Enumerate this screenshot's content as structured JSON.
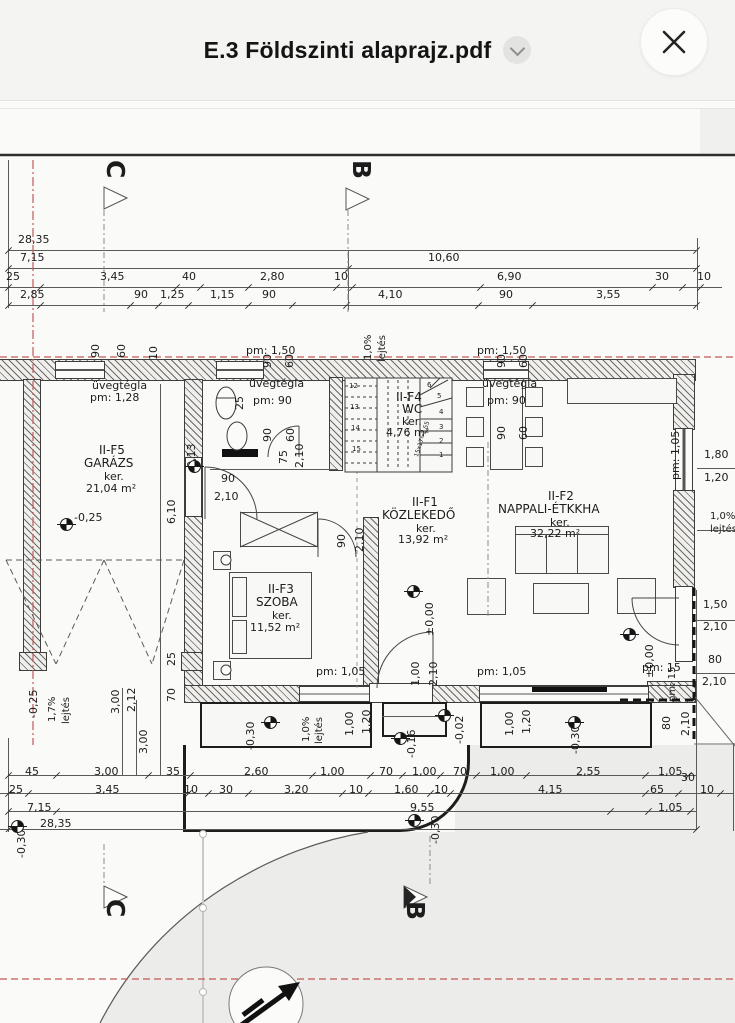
{
  "header": {
    "title": "E.3 Földszinti alaprajz.pdf",
    "dropdown_icon": "chevron-down",
    "close_icon": "close-x"
  },
  "colors": {
    "header_bg": "#f4f4f2",
    "line": "#3d3d3b",
    "axis_red": "#c25a56",
    "ground": "#ececea"
  },
  "plan": {
    "rooms": [
      {
        "id": "II-F5",
        "name": "GARÁZS",
        "area": "21,04 m²"
      },
      {
        "id": "II-F4",
        "name": "WC",
        "area": "4,76 m²"
      },
      {
        "id": "II-F1",
        "name": "KÖZLEKEDŐ",
        "area": "13,92 m²"
      },
      {
        "id": "II-F2",
        "name": "NAPPALI-ÉTKKHA",
        "area": "32,22 m²"
      },
      {
        "id": "II-F3",
        "name": "SZOBA",
        "area": "11,52 m²"
      }
    ],
    "labels": [
      {
        "t": "28,35",
        "x": 18,
        "y": 234
      },
      {
        "t": "7,15",
        "x": 20,
        "y": 252
      },
      {
        "t": "10,60",
        "x": 428,
        "y": 252
      },
      {
        "t": "25",
        "x": 6,
        "y": 271
      },
      {
        "t": "3,45",
        "x": 100,
        "y": 271
      },
      {
        "t": "40",
        "x": 182,
        "y": 271
      },
      {
        "t": "2,80",
        "x": 260,
        "y": 271
      },
      {
        "t": "10",
        "x": 334,
        "y": 271
      },
      {
        "t": "6,90",
        "x": 497,
        "y": 271
      },
      {
        "t": "30",
        "x": 655,
        "y": 271
      },
      {
        "t": "10",
        "x": 697,
        "y": 271
      },
      {
        "t": "2,85",
        "x": 20,
        "y": 289
      },
      {
        "t": "90",
        "x": 134,
        "y": 289
      },
      {
        "t": "1,25",
        "x": 160,
        "y": 289
      },
      {
        "t": "1,15",
        "x": 210,
        "y": 289
      },
      {
        "t": "90",
        "x": 262,
        "y": 289
      },
      {
        "t": "4,10",
        "x": 378,
        "y": 289
      },
      {
        "t": "90",
        "x": 499,
        "y": 289
      },
      {
        "t": "3,55",
        "x": 596,
        "y": 289
      },
      {
        "t": "C",
        "x": 128,
        "y": 160,
        "s": 25,
        "r": 90,
        "b": 1,
        "n": "section-marker-c-top"
      },
      {
        "t": "B",
        "x": 374,
        "y": 160,
        "s": 25,
        "r": 90,
        "b": 1,
        "n": "section-marker-b-top"
      },
      {
        "t": "C",
        "x": 128,
        "y": 899,
        "s": 25,
        "r": 90,
        "b": 1,
        "n": "section-marker-c-bottom"
      },
      {
        "t": "B",
        "x": 428,
        "y": 901,
        "s": 25,
        "r": 90,
        "b": 1,
        "n": "section-marker-b-bottom"
      },
      {
        "t": "90",
        "x": 90,
        "y": 358,
        "r": -90
      },
      {
        "t": "60",
        "x": 116,
        "y": 358,
        "r": -90
      },
      {
        "t": "10",
        "x": 148,
        "y": 360,
        "r": -90
      },
      {
        "t": "90",
        "x": 262,
        "y": 368,
        "r": -90
      },
      {
        "t": "60",
        "x": 284,
        "y": 368,
        "r": -90
      },
      {
        "t": "pm: 1,50",
        "x": 246,
        "y": 345
      },
      {
        "t": "90",
        "x": 496,
        "y": 368,
        "r": -90
      },
      {
        "t": "60",
        "x": 518,
        "y": 368,
        "r": -90
      },
      {
        "t": "pm: 1,50",
        "x": 477,
        "y": 345
      },
      {
        "t": "1,0%",
        "x": 364,
        "y": 360,
        "r": -90,
        "s": 10
      },
      {
        "t": "lejtés",
        "x": 378,
        "y": 362,
        "r": -90,
        "s": 10
      },
      {
        "t": "25",
        "x": 234,
        "y": 410,
        "r": -90
      },
      {
        "t": "üvegtégla",
        "x": 92,
        "y": 380
      },
      {
        "t": "pm: 1,28",
        "x": 90,
        "y": 392
      },
      {
        "t": "üvegtégla",
        "x": 249,
        "y": 378
      },
      {
        "t": "pm: 90",
        "x": 253,
        "y": 395
      },
      {
        "t": "90",
        "x": 262,
        "y": 442,
        "r": -90
      },
      {
        "t": "60",
        "x": 285,
        "y": 442,
        "r": -90
      },
      {
        "t": "II-F4",
        "x": 396,
        "y": 391,
        "s": 12,
        "n": "room-label-wc"
      },
      {
        "t": "WC",
        "x": 402,
        "y": 403,
        "s": 12
      },
      {
        "t": "ker.",
        "x": 402,
        "y": 416
      },
      {
        "t": "4,76 m²",
        "x": 386,
        "y": 427
      },
      {
        "t": "üvegtégla",
        "x": 482,
        "y": 378
      },
      {
        "t": "pm: 90",
        "x": 487,
        "y": 395
      },
      {
        "t": "90",
        "x": 496,
        "y": 440,
        "r": -90
      },
      {
        "t": "60",
        "x": 518,
        "y": 440,
        "r": -90
      },
      {
        "t": "75",
        "x": 278,
        "y": 464,
        "r": -90
      },
      {
        "t": "2,10",
        "x": 294,
        "y": 468,
        "r": -90
      },
      {
        "t": "-0,13",
        "x": 186,
        "y": 472,
        "r": -90
      },
      {
        "t": "pm: 1,05",
        "x": 670,
        "y": 480,
        "r": -90
      },
      {
        "t": "1,80",
        "x": 704,
        "y": 449
      },
      {
        "t": "1,20",
        "x": 704,
        "y": 472
      },
      {
        "t": "1,0%",
        "x": 710,
        "y": 512,
        "s": 10
      },
      {
        "t": "lejtés",
        "x": 710,
        "y": 525,
        "s": 10
      },
      {
        "t": "II-F5",
        "x": 99,
        "y": 444,
        "s": 12,
        "n": "room-label-garazs"
      },
      {
        "t": "GARÁZS",
        "x": 84,
        "y": 457,
        "s": 12
      },
      {
        "t": "ker.",
        "x": 104,
        "y": 471
      },
      {
        "t": "21,04 m²",
        "x": 86,
        "y": 483
      },
      {
        "t": "-0,25",
        "x": 74,
        "y": 512
      },
      {
        "t": "6,10",
        "x": 166,
        "y": 524,
        "r": -90
      },
      {
        "t": "90",
        "x": 221,
        "y": 473
      },
      {
        "t": "2,10",
        "x": 214,
        "y": 491
      },
      {
        "t": "II-F1",
        "x": 412,
        "y": 496,
        "s": 12,
        "n": "room-label-kozlekedo"
      },
      {
        "t": "KÖZLEKEDŐ",
        "x": 382,
        "y": 509,
        "s": 12
      },
      {
        "t": "ker.",
        "x": 416,
        "y": 523
      },
      {
        "t": "13,92 m²",
        "x": 398,
        "y": 534
      },
      {
        "t": "±0,00",
        "x": 424,
        "y": 636,
        "r": -90
      },
      {
        "t": "90",
        "x": 336,
        "y": 548,
        "r": -90
      },
      {
        "t": "2,10",
        "x": 354,
        "y": 552,
        "r": -90
      },
      {
        "t": "II-F2",
        "x": 548,
        "y": 490,
        "s": 12,
        "n": "room-label-nappali"
      },
      {
        "t": "NAPPALI-ÉTKKHA",
        "x": 498,
        "y": 503,
        "s": 12
      },
      {
        "t": "ker.",
        "x": 550,
        "y": 517
      },
      {
        "t": "32,22 m²",
        "x": 530,
        "y": 528
      },
      {
        "t": "±0,00",
        "x": 644,
        "y": 678,
        "r": -90
      },
      {
        "t": "II-F3",
        "x": 268,
        "y": 583,
        "s": 12,
        "n": "room-label-szoba"
      },
      {
        "t": "SZOBA",
        "x": 256,
        "y": 596,
        "s": 12
      },
      {
        "t": "ker.",
        "x": 272,
        "y": 610
      },
      {
        "t": "11,52 m²",
        "x": 250,
        "y": 622
      },
      {
        "t": "pm: 1,05",
        "x": 316,
        "y": 666
      },
      {
        "t": "pm: 1,05",
        "x": 477,
        "y": 666
      },
      {
        "t": "pm: 15",
        "x": 642,
        "y": 662
      },
      {
        "t": "pm: 15",
        "x": 668,
        "y": 702,
        "r": -90,
        "s": 10
      },
      {
        "t": "1,50",
        "x": 703,
        "y": 599
      },
      {
        "t": "2,10",
        "x": 703,
        "y": 621
      },
      {
        "t": "80",
        "x": 708,
        "y": 654
      },
      {
        "t": "2,10",
        "x": 702,
        "y": 676
      },
      {
        "t": "1,00",
        "x": 410,
        "y": 686,
        "r": -90
      },
      {
        "t": "2,10",
        "x": 428,
        "y": 686,
        "r": -90
      },
      {
        "t": "-0,16",
        "x": 406,
        "y": 758,
        "r": -90
      },
      {
        "t": "-0,02",
        "x": 454,
        "y": 744,
        "r": -90
      },
      {
        "t": "1,00",
        "x": 344,
        "y": 736,
        "r": -90
      },
      {
        "t": "1,20",
        "x": 361,
        "y": 734,
        "r": -90
      },
      {
        "t": "-0,30",
        "x": 245,
        "y": 750,
        "r": -90
      },
      {
        "t": "1,0%",
        "x": 302,
        "y": 742,
        "r": -90,
        "s": 10
      },
      {
        "t": "lejtés",
        "x": 315,
        "y": 744,
        "r": -90,
        "s": 10
      },
      {
        "t": "1,00",
        "x": 504,
        "y": 736,
        "r": -90
      },
      {
        "t": "1,20",
        "x": 521,
        "y": 734,
        "r": -90
      },
      {
        "t": "-0,30",
        "x": 570,
        "y": 754,
        "r": -90
      },
      {
        "t": "80",
        "x": 661,
        "y": 730,
        "r": -90
      },
      {
        "t": "2,10",
        "x": 680,
        "y": 736,
        "r": -90
      },
      {
        "t": "45",
        "x": 25,
        "y": 766
      },
      {
        "t": "3,00",
        "x": 94,
        "y": 766
      },
      {
        "t": "35",
        "x": 166,
        "y": 766
      },
      {
        "t": "2,60",
        "x": 244,
        "y": 766
      },
      {
        "t": "1,00",
        "x": 320,
        "y": 766
      },
      {
        "t": "70",
        "x": 379,
        "y": 766
      },
      {
        "t": "1,00",
        "x": 412,
        "y": 766
      },
      {
        "t": "70",
        "x": 453,
        "y": 766
      },
      {
        "t": "1,00",
        "x": 490,
        "y": 766
      },
      {
        "t": "2,55",
        "x": 576,
        "y": 766
      },
      {
        "t": "1,05",
        "x": 658,
        "y": 766
      },
      {
        "t": "30",
        "x": 681,
        "y": 772
      },
      {
        "t": "25",
        "x": 9,
        "y": 784
      },
      {
        "t": "3,45",
        "x": 95,
        "y": 784
      },
      {
        "t": "10",
        "x": 184,
        "y": 784
      },
      {
        "t": "30",
        "x": 219,
        "y": 784
      },
      {
        "t": "3,20",
        "x": 284,
        "y": 784
      },
      {
        "t": "10",
        "x": 349,
        "y": 784
      },
      {
        "t": "1,60",
        "x": 394,
        "y": 784
      },
      {
        "t": "10",
        "x": 434,
        "y": 784
      },
      {
        "t": "4,15",
        "x": 538,
        "y": 784
      },
      {
        "t": "65",
        "x": 650,
        "y": 784
      },
      {
        "t": "10",
        "x": 700,
        "y": 784
      },
      {
        "t": "7,15",
        "x": 27,
        "y": 802
      },
      {
        "t": "9,55",
        "x": 410,
        "y": 802
      },
      {
        "t": "1,05",
        "x": 658,
        "y": 802
      },
      {
        "t": "28,35",
        "x": 40,
        "y": 818
      },
      {
        "t": "-0,30",
        "x": 430,
        "y": 844,
        "r": -90
      },
      {
        "t": "-0,30",
        "x": 16,
        "y": 858,
        "r": -90
      },
      {
        "t": "25",
        "x": 166,
        "y": 666,
        "r": -90
      },
      {
        "t": "3,00",
        "x": 110,
        "y": 714,
        "r": -90
      },
      {
        "t": "2,12",
        "x": 126,
        "y": 712,
        "r": -90
      },
      {
        "t": "70",
        "x": 166,
        "y": 702,
        "r": -90
      },
      {
        "t": "3,00",
        "x": 138,
        "y": 754,
        "r": -90
      },
      {
        "t": "-0,25",
        "x": 28,
        "y": 718,
        "r": -90
      },
      {
        "t": "1,7%",
        "x": 48,
        "y": 722,
        "r": -90,
        "s": 10
      },
      {
        "t": "lejtés",
        "x": 62,
        "y": 724,
        "r": -90,
        "s": 10
      },
      {
        "t": "1",
        "x": 439,
        "y": 452,
        "s": 7
      },
      {
        "t": "2",
        "x": 439,
        "y": 438,
        "s": 7
      },
      {
        "t": "3",
        "x": 439,
        "y": 424,
        "s": 7
      },
      {
        "t": "4",
        "x": 439,
        "y": 409,
        "s": 7
      },
      {
        "t": "5",
        "x": 437,
        "y": 393,
        "s": 7
      },
      {
        "t": "6",
        "x": 427,
        "y": 382,
        "s": 7
      },
      {
        "t": "12",
        "x": 349,
        "y": 383,
        "s": 7
      },
      {
        "t": "13",
        "x": 350,
        "y": 404,
        "s": 7
      },
      {
        "t": "14",
        "x": 351,
        "y": 425,
        "s": 7
      },
      {
        "t": "15",
        "x": 352,
        "y": 446,
        "s": 7
      },
      {
        "t": "15x17=2,55",
        "x": 414,
        "y": 456,
        "r": -72,
        "s": 6
      }
    ],
    "level_markers": [
      {
        "x": 188,
        "y": 460
      },
      {
        "x": 60,
        "y": 518
      },
      {
        "x": 407,
        "y": 585
      },
      {
        "x": 623,
        "y": 628
      },
      {
        "x": 264,
        "y": 716
      },
      {
        "x": 568,
        "y": 716
      },
      {
        "x": 394,
        "y": 732
      },
      {
        "x": 438,
        "y": 709
      },
      {
        "x": 408,
        "y": 814
      },
      {
        "x": 11,
        "y": 820
      }
    ],
    "ticks": [
      {
        "y": 250,
        "xs": [
          8,
          696
        ]
      },
      {
        "y": 268,
        "xs": [
          8,
          348,
          696
        ]
      },
      {
        "y": 287,
        "xs": [
          8,
          40,
          176,
          200,
          248,
          336,
          352,
          480,
          652,
          682,
          700
        ]
      },
      {
        "y": 305,
        "xs": [
          8,
          40,
          130,
          158,
          188,
          248,
          292,
          346,
          478,
          532,
          696
        ]
      },
      {
        "y": 775,
        "xs": [
          8,
          56,
          148,
          190,
          312,
          370,
          402,
          440,
          476,
          526,
          645,
          688
        ]
      },
      {
        "y": 793,
        "xs": [
          8,
          28,
          188,
          208,
          248,
          342,
          368,
          430,
          450,
          645,
          678,
          720
        ]
      },
      {
        "y": 811,
        "xs": [
          8,
          56,
          610,
          648,
          690
        ]
      },
      {
        "y": 829,
        "xs": [
          8,
          696
        ]
      }
    ]
  }
}
